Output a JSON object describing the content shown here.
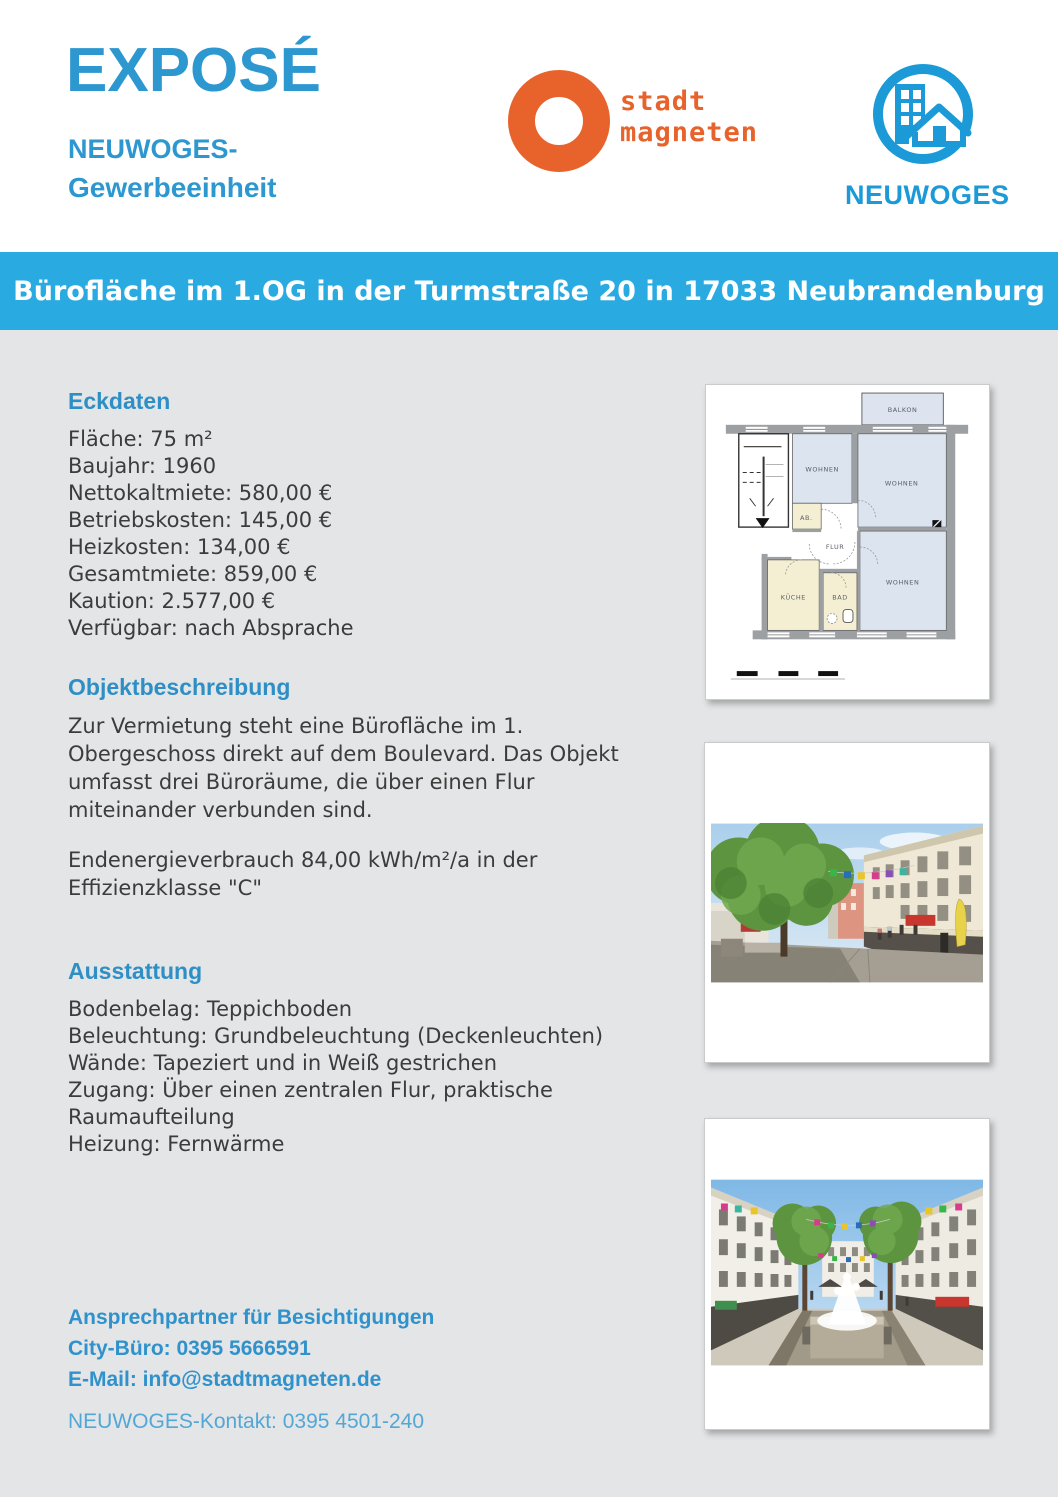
{
  "header": {
    "title": "EXPOSÉ",
    "subtitle_line1": "NEUWOGES-",
    "subtitle_line2": "Gewerbeeinheit",
    "stadtmagneten_logo": {
      "line1": "stadt",
      "line2": "magneten",
      "color": "#e8632c"
    },
    "neuwoges_logo": {
      "text": "NEUWOGES",
      "color": "#1b9ad7"
    }
  },
  "banner": {
    "title": "Bürofläche im 1.OG in der Turmstraße 20 in 17033 Neubrandenburg",
    "background": "#29abe2"
  },
  "sections": {
    "eckdaten": {
      "heading": "Eckdaten",
      "items": [
        "Fläche: 75 m²",
        "Baujahr: 1960",
        "Nettokaltmiete: 580,00 €",
        "Betriebskosten: 145,00 €",
        "Heizkosten: 134,00 €",
        "Gesamtmiete: 859,00 €",
        "Kaution: 2.577,00 €",
        "Verfügbar: nach Absprache"
      ]
    },
    "objektbeschreibung": {
      "heading": "Objektbeschreibung",
      "paragraph1": "Zur Vermietung steht eine Bürofläche im 1. Obergeschoss direkt auf dem Boulevard. Das Objekt umfasst drei Büroräume, die über einen Flur miteinander verbunden sind.",
      "paragraph2": "Endenergieverbrauch 84,00 kWh/m²/a in der Effizienzklasse \"C\""
    },
    "ausstattung": {
      "heading": "Ausstattung",
      "items": [
        "Bodenbelag: Teppichboden",
        "Beleuchtung: Grundbeleuchtung (Deckenleuchten)",
        "Wände: Tapeziert und in Weiß gestrichen",
        "Zugang: Über einen zentralen Flur, praktische Raumaufteilung",
        "Heizung: Fernwärme"
      ]
    }
  },
  "floorplan": {
    "rooms": {
      "balkon": "BALKON",
      "wohnen1": "WOHNEN",
      "wohnen2": "WOHNEN",
      "wohnen3": "WOHNEN",
      "ab": "AB.",
      "flur": "FLUR",
      "kueche": "KÜCHE",
      "bad": "BAD"
    }
  },
  "contact": {
    "heading": "Ansprechpartner für Besichtigungen",
    "phone_line": "City-Büro: 0395 5666591",
    "email_line": "E-Mail: info@stadtmagneten.de",
    "neuwoges_line": "NEUWOGES-Kontakt: 0395 4501-240"
  },
  "colors": {
    "accent_blue": "#2d97d0",
    "banner_blue": "#29abe2",
    "logo_orange": "#e8632c",
    "neuwoges_blue": "#1b9ad7",
    "page_background": "#e3e5e6",
    "body_text": "#3c3c3c"
  }
}
